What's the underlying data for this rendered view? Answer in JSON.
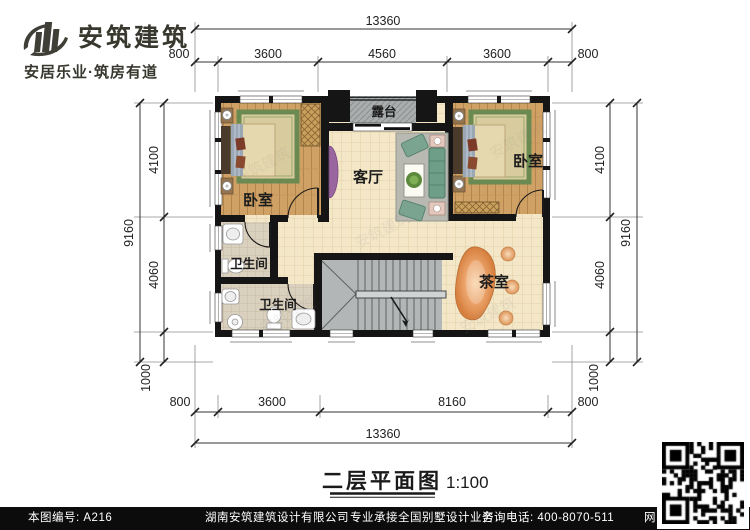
{
  "logo": {
    "title": "安筑建筑",
    "tagline": "安居乐业·筑房有道"
  },
  "rooms": {
    "terrace": "露台",
    "bedroom_left": "卧室",
    "bedroom_right": "卧室",
    "living_room": "客厅",
    "bathroom_upper": "卫生间",
    "bathroom_lower": "卫生间",
    "tea_room": "茶室"
  },
  "dims": {
    "top_total": "13360",
    "top_eave_left": "800",
    "top_seg_1": "3600",
    "top_seg_2": "4560",
    "top_seg_3": "3600",
    "top_eave_right": "800",
    "left_total": "9160",
    "left_seg_1": "4100",
    "left_seg_2": "4060",
    "left_seg_3": "1000",
    "right_total": "9160",
    "right_seg_1": "4100",
    "right_seg_2": "4060",
    "right_seg_3": "1000",
    "bottom_eave_left": "800",
    "bottom_seg_1": "3600",
    "bottom_seg_2": "8160",
    "bottom_eave_right": "800",
    "bottom_total": "13360"
  },
  "caption": {
    "title": "二层平面图",
    "scale": "1:100"
  },
  "footer": {
    "sheet_no": "本图编号: A216",
    "company": "湖南安筑建筑设计有限公司",
    "service": "专业承接全国别墅设计业务",
    "phone": "咨询电话: 400-8070-511",
    "web_char": "网"
  },
  "watermark": {
    "text": "安筑建筑"
  },
  "colors": {
    "wall": "#151515",
    "floor_tile": "#f3e7c7",
    "floor_wood": "#cfa164",
    "bath_tile": "#dad0be",
    "terrace": "#a9adad",
    "stairs": "#b2b6b6",
    "tea_table": "#e59a5d",
    "rug_green": "#6a8a52",
    "sofa_green": "#6f9e88",
    "accent_purple": "#9a66a0"
  }
}
